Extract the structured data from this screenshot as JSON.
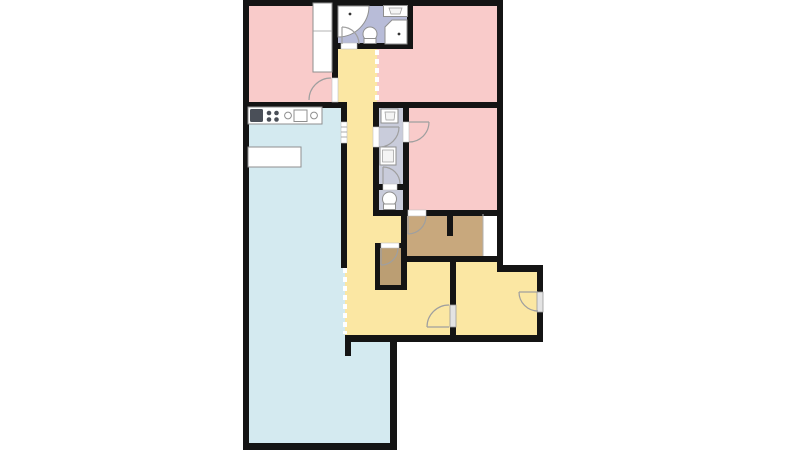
{
  "colors": {
    "page_background": "#ffffff",
    "wall": "#141414",
    "room_pink": "#f9cbca",
    "room_gray": "#b8bcd8",
    "room_gray_light": "#c9ccdb",
    "room_yellow": "#fbe7a3",
    "room_blue": "#d4eaf0",
    "room_tan": "#c8a87d",
    "room_tan_dark": "#bb9e73",
    "fixture": "#ffffff",
    "fixture_border": "#8f8f8f",
    "appliance_dark": "#4a4f58",
    "door_arc": "#9f9f9f",
    "door_slab": "#e3e3e3",
    "open_boundary": "#ffffff"
  },
  "rooms": [
    {
      "id": "room-top-left",
      "color_key": "room_pink"
    },
    {
      "id": "bathroom",
      "color_key": "room_gray"
    },
    {
      "id": "room-top-right",
      "color_key": "room_pink"
    },
    {
      "id": "bedroom-right",
      "color_key": "room_pink"
    },
    {
      "id": "hallway",
      "color_key": "room_yellow"
    },
    {
      "id": "kitchen-living-room",
      "color_key": "room_blue"
    },
    {
      "id": "utility-hall",
      "color_key": "room_gray_light"
    },
    {
      "id": "wc",
      "color_key": "room_gray_light"
    },
    {
      "id": "walk-in-closet",
      "color_key": "room_tan"
    },
    {
      "id": "small-closet",
      "color_key": "room_tan_dark"
    },
    {
      "id": "hall-room-left",
      "color_key": "room_yellow"
    },
    {
      "id": "hall-room-right",
      "color_key": "room_yellow"
    }
  ],
  "fixtures": [
    "corner-bathtub",
    "bathroom-sink",
    "bathroom-toilet",
    "corner-shower",
    "wardrobe",
    "kitchen-counter",
    "stove",
    "kitchen-sink",
    "kitchen-table",
    "utility-sink",
    "washing-machine",
    "wc-toilet",
    "entrance-door"
  ]
}
